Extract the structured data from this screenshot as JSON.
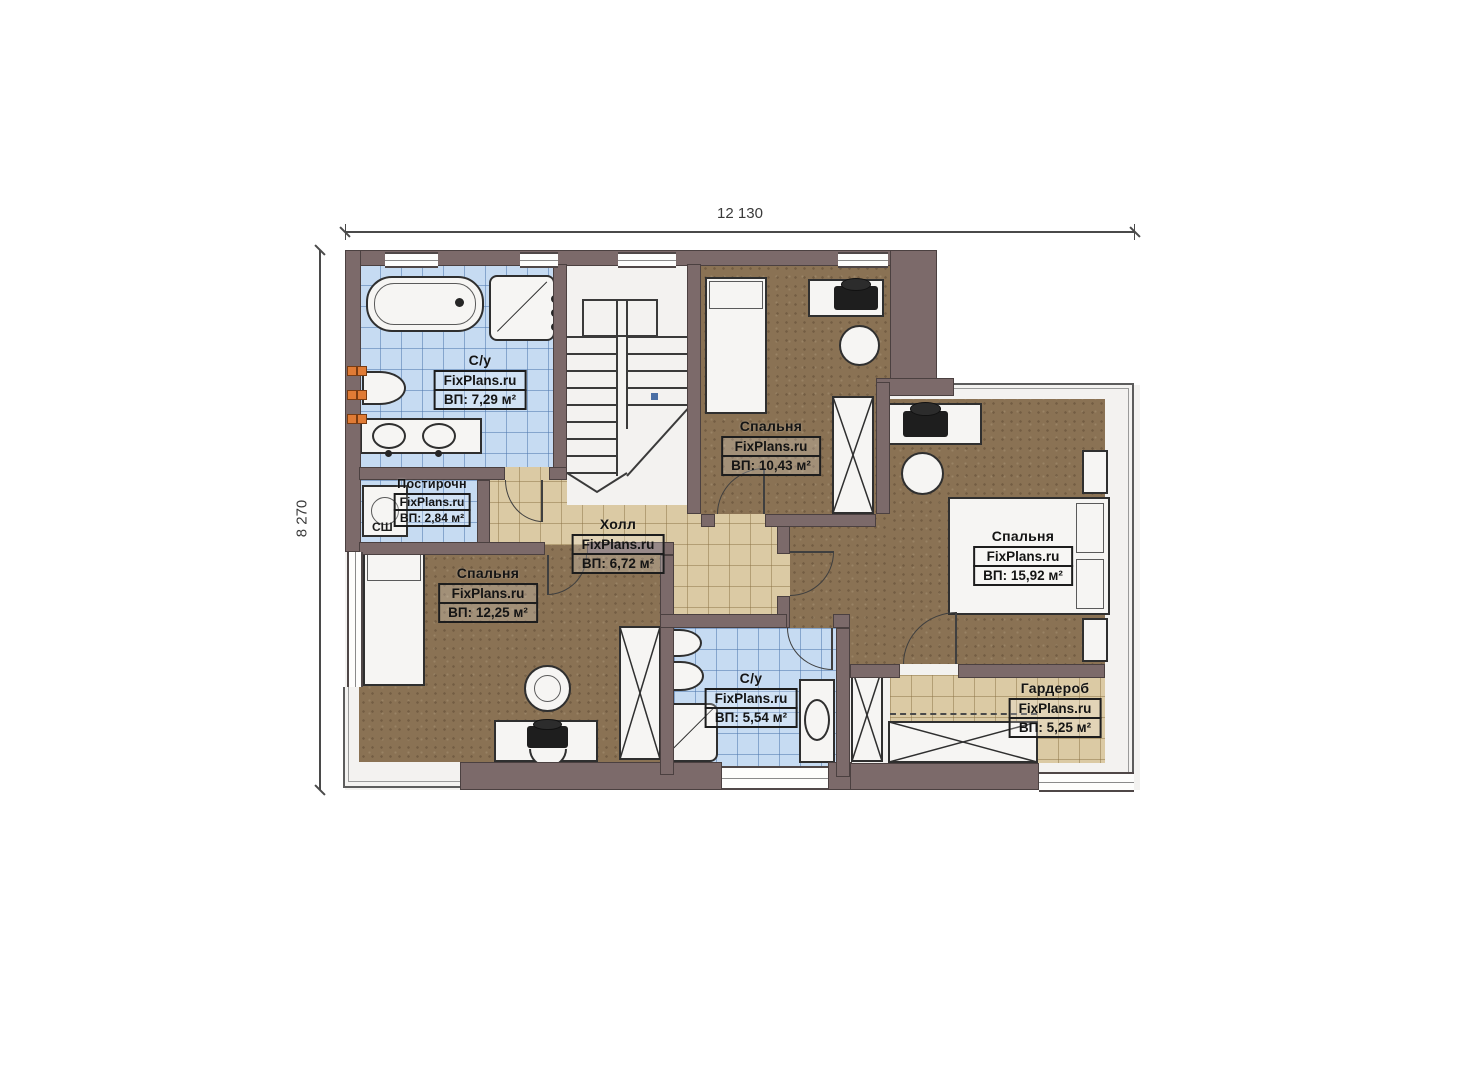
{
  "plan": {
    "dimension_width_label": "12 130",
    "dimension_height_label": "8 270",
    "brand": "FixPlans.ru",
    "rooms": [
      {
        "id": "bathroom-upper",
        "name": "С/у",
        "brand": "FixPlans.ru",
        "area": "ВП: 7,29 м²"
      },
      {
        "id": "laundry",
        "name": "Постирочн",
        "brand": "FixPlans.ru",
        "area": "ВП: 2,84 м²",
        "equipment_label": "СШ"
      },
      {
        "id": "hall",
        "name": "Холл",
        "brand": "FixPlans.ru",
        "area": "ВП: 6,72 м²"
      },
      {
        "id": "bedroom-top",
        "name": "Спальня",
        "brand": "FixPlans.ru",
        "area": "ВП: 10,43 м²"
      },
      {
        "id": "bedroom-right",
        "name": "Спальня",
        "brand": "FixPlans.ru",
        "area": "ВП: 15,92 м²"
      },
      {
        "id": "bedroom-left",
        "name": "Спальня",
        "brand": "FixPlans.ru",
        "area": "ВП: 12,25 м²"
      },
      {
        "id": "bathroom-lower",
        "name": "С/у",
        "brand": "FixPlans.ru",
        "area": "ВП: 5,54 м²"
      },
      {
        "id": "wardrobe",
        "name": "Гардероб",
        "brand": "FixPlans.ru",
        "area": "ВП: 5,25 м²"
      }
    ],
    "colors": {
      "wall": "#7c6a6a",
      "tile_blue": "#c6dbf2",
      "tile_tan": "#dbcaa4",
      "carpet_brown": "#8a7254",
      "radiator": "#e07b35"
    }
  }
}
